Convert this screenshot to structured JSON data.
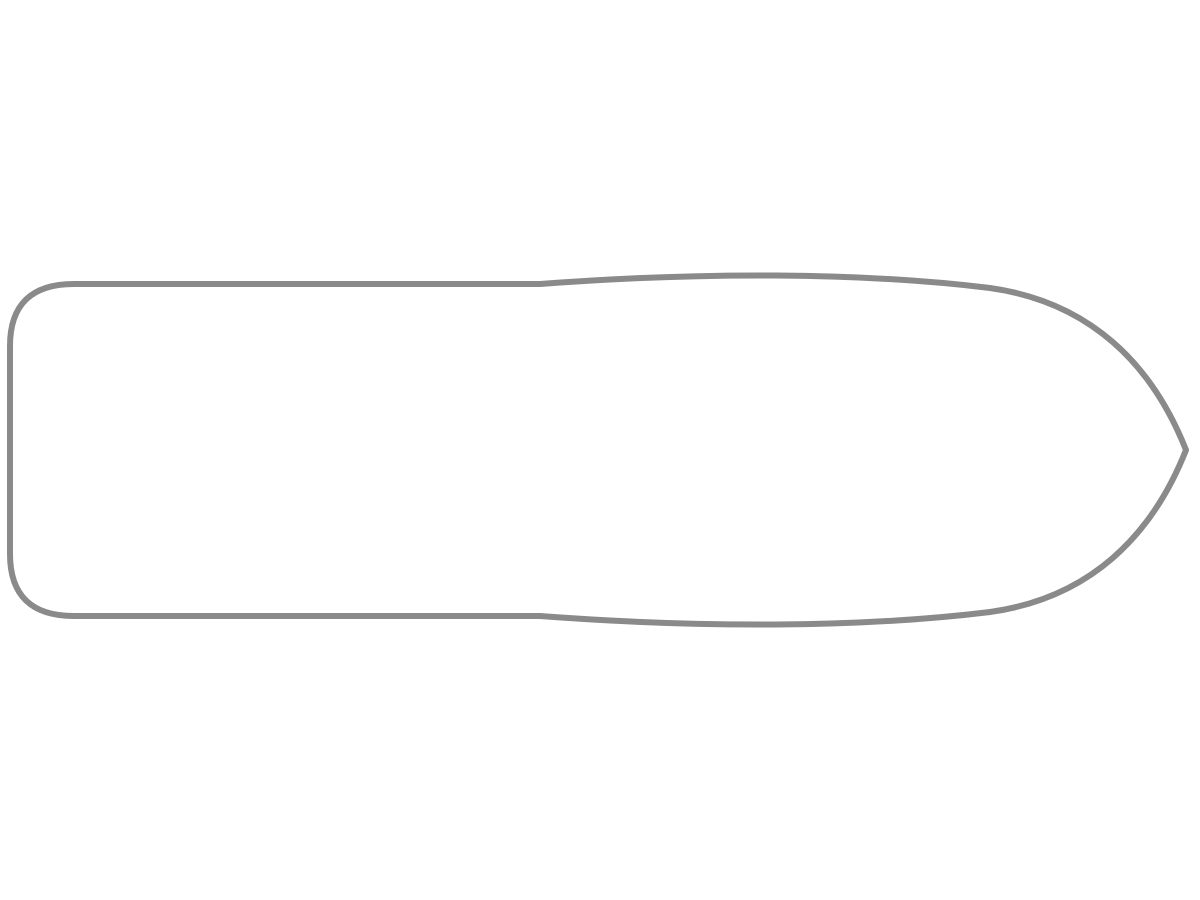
{
  "document": {
    "kind": "boat-deck-floor-plan",
    "orientation": "stern-left-bow-right",
    "visible_text": []
  },
  "colors": {
    "hull_outline": "#8a8a8a",
    "deck_outline": "#c7c7c7",
    "wall": "#5b381b",
    "wood_dark": "#6e4522",
    "floor_a": "#dbd2b3",
    "floor_b": "#cfc5a2",
    "floor_line": "#91875f",
    "bench": "#d9cead",
    "bench_light": "#e3dcc0",
    "bench_shade": "#a3966e",
    "table_top": "#f3efdf",
    "mint": "#b7e3c9",
    "blanket": "#ccc7c0",
    "blanket_grid": "#e8e5df",
    "pillow": "#edebe3",
    "pillow_edge": "#b6b2a7",
    "bath": "#f6f6f3",
    "fixture": "#c2c2bc",
    "zone": "#e7e7e4",
    "hatch": "#161616",
    "steel": "#e8e8e5"
  },
  "plan": {
    "areas": [
      {
        "name": "aft-deck",
        "items": [
          "corner-bench",
          "side-bench",
          "deck-table",
          "boarding-step",
          "companionway-stairs"
        ]
      },
      {
        "name": "galley",
        "items": [
          "cabinet",
          "two-burner-stove-modules",
          "double-sink-with-drainer",
          "tall-cupboard"
        ]
      },
      {
        "name": "salon",
        "items": [
          "u-shaped-dinette-bench",
          "oval-table",
          "shelf-strips",
          "helm-seat",
          "steering-wheel",
          "instrument-console",
          "dashboard"
        ]
      },
      {
        "name": "mid-cabin-port",
        "items": [
          "double-bed",
          "pillows",
          "duvet",
          "bifold-door"
        ]
      },
      {
        "name": "mid-cabin-starboard",
        "items": [
          "bed",
          "pillows",
          "duvet"
        ]
      },
      {
        "name": "bathroom-port",
        "items": [
          "washbasin",
          "toilet",
          "round-shower"
        ]
      },
      {
        "name": "bathroom-starboard-1",
        "items": [
          "round-shower",
          "toilet",
          "washbasin"
        ]
      },
      {
        "name": "bathroom-starboard-2",
        "items": [
          "round-shower",
          "toilet",
          "washbasin"
        ]
      },
      {
        "name": "bow-cabin",
        "items": [
          "double-bed",
          "pillows",
          "duvet",
          "storage-shelves",
          "heater-hatch-symbols"
        ]
      },
      {
        "name": "bow-deck",
        "items": []
      }
    ]
  }
}
